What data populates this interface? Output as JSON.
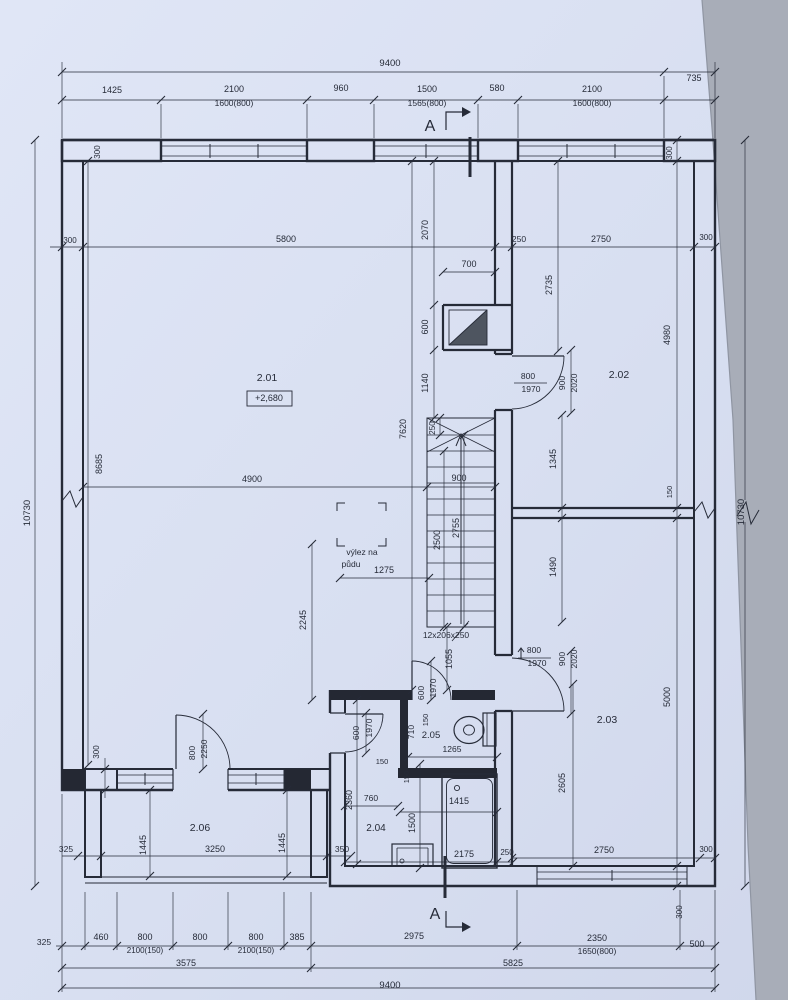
{
  "colors": {
    "paper": "#d8dff1",
    "paper_light": "#e0e6f6",
    "ink": "#262b38",
    "wall_fill": "#242833",
    "chimney_fill": "#4e5560",
    "photo_edge": "#a8adb8"
  },
  "drawing": {
    "type": "floor-plan",
    "section_marker": "A",
    "stair_note": "12x206x250",
    "attic_hatch_note": "výlez na půdu",
    "rooms": [
      {
        "number": "2.01",
        "level": "+2,680"
      },
      {
        "number": "2.02"
      },
      {
        "number": "2.03"
      },
      {
        "number": "2.04"
      },
      {
        "number": "2.05"
      },
      {
        "number": "2.06"
      }
    ],
    "annotations": [
      {
        "n": "dim-top-overall",
        "t": "9400",
        "x": 390,
        "y": 66,
        "s": 9.5
      },
      {
        "n": "dim-top-735",
        "t": "735",
        "x": 694,
        "y": 81
      },
      {
        "n": "dim-top-1425",
        "t": "1425",
        "x": 112,
        "y": 93
      },
      {
        "n": "dim-top-window1",
        "t": "2100",
        "x": 234,
        "y": 92
      },
      {
        "n": "dim-top-window1-size",
        "t": "1600(800)",
        "x": 234,
        "y": 106,
        "s": 8.5
      },
      {
        "n": "dim-top-pier1",
        "t": "960",
        "x": 341,
        "y": 91
      },
      {
        "n": "dim-top-window2",
        "t": "1500",
        "x": 427,
        "y": 92
      },
      {
        "n": "dim-top-window2-size",
        "t": "1565(800)",
        "x": 427,
        "y": 106,
        "s": 8.5
      },
      {
        "n": "dim-top-pier2",
        "t": "580",
        "x": 497,
        "y": 91
      },
      {
        "n": "dim-top-window3",
        "t": "2100",
        "x": 592,
        "y": 92
      },
      {
        "n": "dim-top-window3-size",
        "t": "1600(800)",
        "x": 592,
        "y": 106,
        "s": 8.5
      },
      {
        "n": "section-marker-top",
        "t": "A",
        "x": 430,
        "y": 131,
        "s": 16
      },
      {
        "n": "dim-300-pillar-topleft",
        "t": "300",
        "x": 100,
        "y": 152,
        "r": -90,
        "s": 8
      },
      {
        "n": "dim-300-pillar-topright",
        "t": "300",
        "x": 672,
        "y": 153,
        "r": -90,
        "s": 8
      },
      {
        "n": "dim-left-overall",
        "t": "10730",
        "x": 30,
        "y": 513,
        "r": -90,
        "s": 9.5
      },
      {
        "n": "dim-left-8685",
        "t": "8685",
        "x": 102,
        "y": 464,
        "r": -90
      },
      {
        "n": "dim-300-wall-left",
        "t": "300",
        "x": 70,
        "y": 243,
        "s": 8
      },
      {
        "n": "dim-300-wall-bottomleft",
        "t": "300",
        "x": 99,
        "y": 752,
        "r": -90,
        "s": 8
      },
      {
        "n": "dim-room1-5800",
        "t": "5800",
        "x": 286,
        "y": 242
      },
      {
        "n": "room-label-2-01",
        "t": "2.01",
        "x": 267,
        "y": 381,
        "s": 10.5
      },
      {
        "n": "level-label",
        "t": "+2,680",
        "x": 269,
        "y": 401,
        "s": 9
      },
      {
        "n": "dim-room1-4900",
        "t": "4900",
        "x": 252,
        "y": 482
      },
      {
        "n": "dim-2245",
        "t": "2245",
        "x": 306,
        "y": 620,
        "r": -90
      },
      {
        "n": "dim-1275",
        "t": "1275",
        "x": 384,
        "y": 573
      },
      {
        "n": "attic-hatch-label-1",
        "t": "výlez na",
        "x": 362,
        "y": 555,
        "s": 8.5
      },
      {
        "n": "attic-hatch-label-2",
        "t": "půdu",
        "x": 351,
        "y": 567,
        "s": 8.5
      },
      {
        "n": "dim-2070",
        "t": "2070",
        "x": 428,
        "y": 230,
        "r": -90
      },
      {
        "n": "dim-700",
        "t": "700",
        "x": 469,
        "y": 267
      },
      {
        "n": "dim-600-chimney",
        "t": "600",
        "x": 428,
        "y": 327,
        "r": -90
      },
      {
        "n": "dim-1140",
        "t": "1140",
        "x": 428,
        "y": 383,
        "r": -90
      },
      {
        "n": "dim-7620",
        "t": "7620",
        "x": 406,
        "y": 429,
        "r": -90
      },
      {
        "n": "dim-250-stair",
        "t": "250",
        "x": 435,
        "y": 428,
        "r": -90,
        "s": 8
      },
      {
        "n": "dim-900-stair",
        "t": "900",
        "x": 459,
        "y": 481
      },
      {
        "n": "dim-2500",
        "t": "2500",
        "x": 440,
        "y": 540,
        "r": -90
      },
      {
        "n": "dim-2755",
        "t": "2755",
        "x": 459,
        "y": 528,
        "r": -90
      },
      {
        "n": "stair-label",
        "t": "12x206x250",
        "x": 446,
        "y": 638,
        "s": 8.5
      },
      {
        "n": "dim-1055",
        "t": "1055",
        "x": 452,
        "y": 659,
        "r": -90
      },
      {
        "n": "dim-150-a",
        "t": "150",
        "x": 428,
        "y": 720,
        "r": -90,
        "s": 7.5
      },
      {
        "n": "dim-710",
        "t": "710",
        "x": 414,
        "y": 732,
        "r": -90,
        "s": 8.5
      },
      {
        "n": "door-wc-600",
        "t": "600",
        "x": 424,
        "y": 693,
        "r": -90,
        "s": 8.5
      },
      {
        "n": "door-wc-1970",
        "t": "1970",
        "x": 436,
        "y": 688,
        "r": -90,
        "s": 8.5
      },
      {
        "n": "dim-150-b",
        "t": "150",
        "x": 382,
        "y": 764,
        "s": 7.5
      },
      {
        "n": "dim-150-c",
        "t": "150",
        "x": 409,
        "y": 777,
        "r": -90,
        "s": 7.5
      },
      {
        "n": "room-label-2-05",
        "t": "2.05",
        "x": 431,
        "y": 738,
        "s": 9.5
      },
      {
        "n": "dim-1265",
        "t": "1265",
        "x": 452,
        "y": 752,
        "s": 8.5
      },
      {
        "n": "door-lobby-600",
        "t": "600",
        "x": 359,
        "y": 733,
        "r": -90,
        "s": 8.5
      },
      {
        "n": "door-lobby-1970",
        "t": "1970",
        "x": 372,
        "y": 728,
        "r": -90,
        "s": 8.5
      },
      {
        "n": "dim-2360",
        "t": "2360",
        "x": 352,
        "y": 800,
        "r": -90
      },
      {
        "n": "dim-760",
        "t": "760",
        "x": 371,
        "y": 801,
        "s": 8.5
      },
      {
        "n": "dim-1500",
        "t": "1500",
        "x": 415,
        "y": 823,
        "r": -90
      },
      {
        "n": "dim-1415",
        "t": "1415",
        "x": 459,
        "y": 804
      },
      {
        "n": "room-label-2-04",
        "t": "2.04",
        "x": 376,
        "y": 831,
        "s": 10
      },
      {
        "n": "dim-2175",
        "t": "2175",
        "x": 464,
        "y": 857
      },
      {
        "n": "dim-250-wall-bottom",
        "t": "250",
        "x": 507,
        "y": 855,
        "s": 8
      },
      {
        "n": "dim-bottom-2975",
        "t": "2975",
        "x": 414,
        "y": 939
      },
      {
        "n": "section-marker-bottom",
        "t": "A",
        "x": 435,
        "y": 919,
        "s": 16
      },
      {
        "n": "dim-250-wall-top",
        "t": "250",
        "x": 519,
        "y": 242,
        "s": 8.5
      },
      {
        "n": "dim-2750-top",
        "t": "2750",
        "x": 601,
        "y": 242
      },
      {
        "n": "dim-300-topright-h",
        "t": "300",
        "x": 706,
        "y": 240,
        "s": 8
      },
      {
        "n": "dim-2735",
        "t": "2735",
        "x": 552,
        "y": 285,
        "r": -90
      },
      {
        "n": "door-202-800",
        "t": "800",
        "x": 528,
        "y": 379,
        "s": 8.5
      },
      {
        "n": "door-202-1970",
        "t": "1970",
        "x": 531,
        "y": 392,
        "s": 8.5
      },
      {
        "n": "door-202-900",
        "t": "900",
        "x": 565,
        "y": 383,
        "r": -90,
        "s": 8.5
      },
      {
        "n": "door-202-2020",
        "t": "2020",
        "x": 577,
        "y": 383,
        "r": -90,
        "s": 8.5
      },
      {
        "n": "room-label-2-02",
        "t": "2.02",
        "x": 619,
        "y": 378,
        "s": 10.5
      },
      {
        "n": "dim-4980",
        "t": "4980",
        "x": 670,
        "y": 335,
        "r": -90
      },
      {
        "n": "dim-1345",
        "t": "1345",
        "x": 556,
        "y": 459,
        "r": -90
      },
      {
        "n": "dim-150-wall-right",
        "t": "150",
        "x": 672,
        "y": 492,
        "r": -90,
        "s": 7.5
      },
      {
        "n": "dim-right-overall",
        "t": "10730",
        "x": 744,
        "y": 512,
        "r": -90,
        "s": 9.5
      },
      {
        "n": "dim-1490",
        "t": "1490",
        "x": 556,
        "y": 567,
        "r": -90
      },
      {
        "n": "door-203-800",
        "t": "800",
        "x": 534,
        "y": 653,
        "s": 8.5
      },
      {
        "n": "door-203-1970",
        "t": "1970",
        "x": 537,
        "y": 666,
        "s": 8.5
      },
      {
        "n": "door-203-900",
        "t": "900",
        "x": 565,
        "y": 659,
        "r": -90,
        "s": 8.5
      },
      {
        "n": "door-203-2020",
        "t": "2020",
        "x": 577,
        "y": 659,
        "r": -90,
        "s": 8.5
      },
      {
        "n": "room-label-2-03",
        "t": "2.03",
        "x": 607,
        "y": 723,
        "s": 10.5
      },
      {
        "n": "dim-5000",
        "t": "5000",
        "x": 670,
        "y": 697,
        "r": -90
      },
      {
        "n": "dim-2605",
        "t": "2605",
        "x": 565,
        "y": 783,
        "r": -90
      },
      {
        "n": "dim-2750-bottom",
        "t": "2750",
        "x": 604,
        "y": 853
      },
      {
        "n": "dim-300-bottomright-h",
        "t": "300",
        "x": 706,
        "y": 852,
        "s": 8
      },
      {
        "n": "dim-300-bottomright-v",
        "t": "300",
        "x": 682,
        "y": 912,
        "r": -90,
        "s": 8
      },
      {
        "n": "dim-bottom-325",
        "t": "325",
        "x": 44,
        "y": 945,
        "s": 8.5
      },
      {
        "n": "dim-bottom-460",
        "t": "460",
        "x": 101,
        "y": 940
      },
      {
        "n": "dim-bottom-w1",
        "t": "800",
        "x": 145,
        "y": 940
      },
      {
        "n": "dim-bottom-w1-size",
        "t": "2100(150)",
        "x": 145,
        "y": 953,
        "s": 8
      },
      {
        "n": "dim-bottom-door",
        "t": "800",
        "x": 200,
        "y": 940
      },
      {
        "n": "dim-bottom-w2",
        "t": "800",
        "x": 256,
        "y": 940
      },
      {
        "n": "dim-bottom-w2-size",
        "t": "2100(150)",
        "x": 256,
        "y": 953,
        "s": 8
      },
      {
        "n": "dim-bottom-385",
        "t": "385",
        "x": 297,
        "y": 940
      },
      {
        "n": "dim-bottom-2350",
        "t": "2350",
        "x": 597,
        "y": 941
      },
      {
        "n": "dim-bottom-window-size",
        "t": "1650(800)",
        "x": 597,
        "y": 954,
        "s": 8.5
      },
      {
        "n": "dim-bottom-500",
        "t": "500",
        "x": 697,
        "y": 947
      },
      {
        "n": "dim-bottom-3575",
        "t": "3575",
        "x": 186,
        "y": 966
      },
      {
        "n": "dim-bottom-5825",
        "t": "5825",
        "x": 513,
        "y": 966
      },
      {
        "n": "dim-bottom-overall",
        "t": "9400",
        "x": 390,
        "y": 988,
        "s": 9.5
      },
      {
        "n": "room-label-2-06",
        "t": "2.06",
        "x": 200,
        "y": 831,
        "s": 10.5
      },
      {
        "n": "dim-balcony-1445-left",
        "t": "1445",
        "x": 146,
        "y": 845,
        "r": -90
      },
      {
        "n": "dim-balcony-1445-right",
        "t": "1445",
        "x": 285,
        "y": 843,
        "r": -90
      },
      {
        "n": "dim-balcony-325",
        "t": "325",
        "x": 66,
        "y": 852,
        "s": 8.5
      },
      {
        "n": "dim-balcony-3250",
        "t": "3250",
        "x": 215,
        "y": 852
      },
      {
        "n": "dim-balcony-350",
        "t": "350",
        "x": 342,
        "y": 852,
        "s": 8.5
      },
      {
        "n": "door-balcony-800",
        "t": "800",
        "x": 195,
        "y": 753,
        "r": -90,
        "s": 8.5
      },
      {
        "n": "door-balcony-2250",
        "t": "2250",
        "x": 207,
        "y": 749,
        "r": -90,
        "s": 8.5
      }
    ]
  }
}
